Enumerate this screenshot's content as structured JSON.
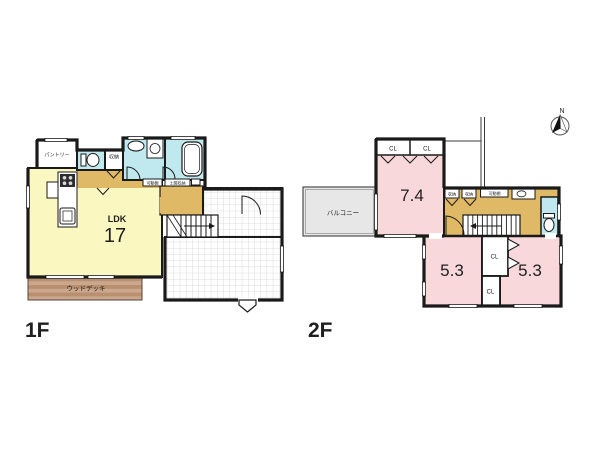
{
  "colors": {
    "wall": "#1a1a1a",
    "ldk_yellow": "#faf7c0",
    "hall_tan": "#dfb966",
    "room_pink": "#f8d8da",
    "wet_cyan": "#bfe9ee",
    "balcony_gray": "#e7e7e7",
    "deck_light": "#cba78d",
    "deck_dark": "#b9906f"
  },
  "f1": {
    "label": "1F",
    "ldk_type": "LDK",
    "ldk_size": "17",
    "pantry": "パントリー",
    "closet": "収納",
    "movable_shelf": "可動棚",
    "doma_storage": "土間収納",
    "wood_deck": "ウッドデッキ"
  },
  "f2": {
    "label": "2F",
    "balcony": "バルコニー",
    "room_main_size": "7.4",
    "room_a_size": "5.3",
    "room_b_size": "5.3",
    "cl": "CL",
    "storage": "収納",
    "movable_shelf": "可動棚"
  },
  "compass": {
    "north": "N"
  }
}
